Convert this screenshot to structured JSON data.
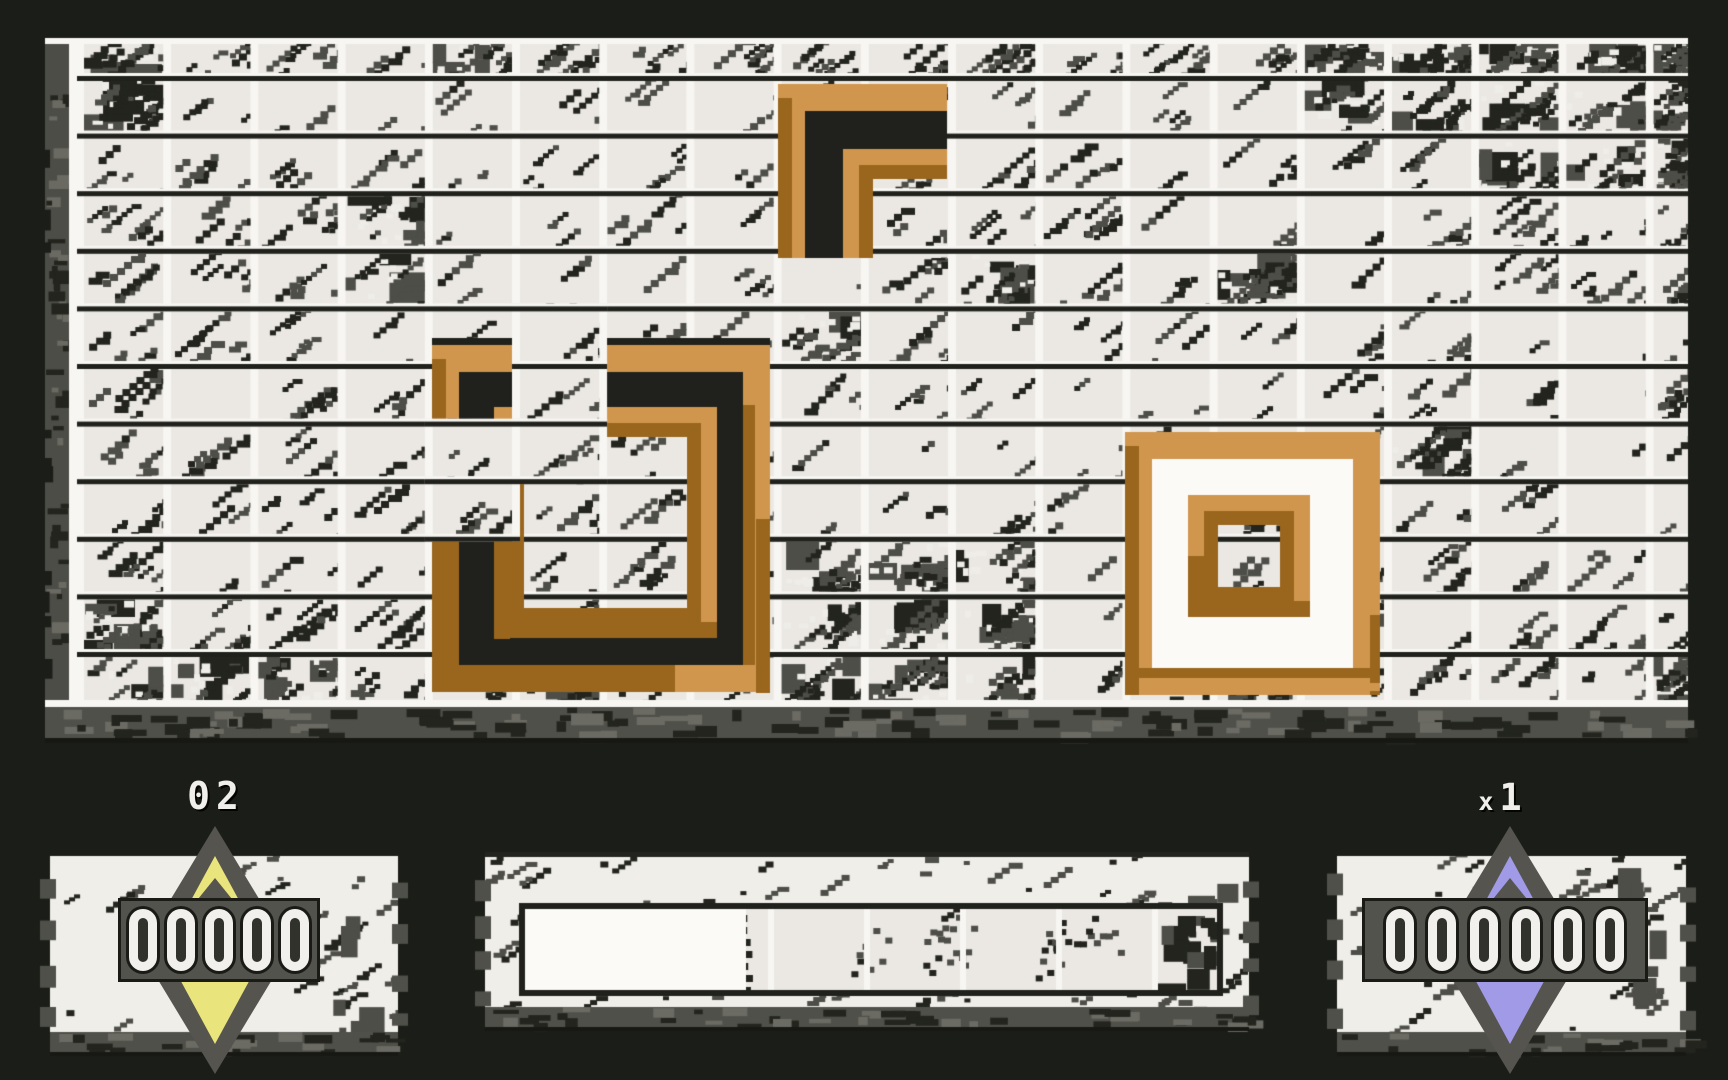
{
  "colors": {
    "background": "#1b1d18",
    "cell": "#ebe8e3",
    "grid_white": "#f7f6f2",
    "grid_black": "#20211c",
    "scratch_dark": "#23241e",
    "scratch_gray": "#4e4e48",
    "edge_gray": "#4d4d47",
    "block_light": "#d0964e",
    "block_dark": "#9a661d",
    "moat_black": "#20211c",
    "moat_white": "#fbfaf7",
    "panel": "#f0eee9",
    "panel_shadow": "#50504a",
    "counter_bg": "#53534d",
    "outline_black": "#1a1b17",
    "digit_white": "#f2f0ed",
    "diamond_gray": "#55544e",
    "diamond_yellow": "#e9e47c",
    "diamond_blue": "#a19ae7",
    "label_white": "#f0efec"
  },
  "playfield": {
    "grid": {
      "cols": 18,
      "rows": 11
    },
    "pieces": [
      {
        "name": "corner-block-piece",
        "shape": "corner",
        "moat": "black",
        "bbox": [
          778,
          84,
          169,
          174
        ]
      },
      {
        "name": "broken-ring-piece",
        "shape": "ring",
        "moat": "black",
        "bbox": [
          432,
          345,
          338,
          347
        ],
        "inner_bbox": [
          494,
          407,
          223,
          231
        ],
        "gap_cells": [
          [
            5,
            4
          ],
          [
            5,
            5
          ],
          [
            5,
            6
          ],
          [
            4,
            6
          ],
          [
            4,
            7
          ]
        ]
      },
      {
        "name": "double-ring-piece",
        "shape": "ring",
        "moat": "white",
        "bbox": [
          1125,
          432,
          255,
          263
        ],
        "inner_bbox": [
          1188,
          495,
          122,
          122
        ],
        "gap_cells": []
      }
    ]
  },
  "hud": {
    "left": {
      "label": "02",
      "counter": "00000",
      "diamond_color": "#e9e47c"
    },
    "center": {
      "meter_fill_fraction": 0.32,
      "segment_separators": 5
    },
    "right": {
      "label": "x1",
      "counter": "000000",
      "diamond_color": "#a19ae7"
    }
  }
}
